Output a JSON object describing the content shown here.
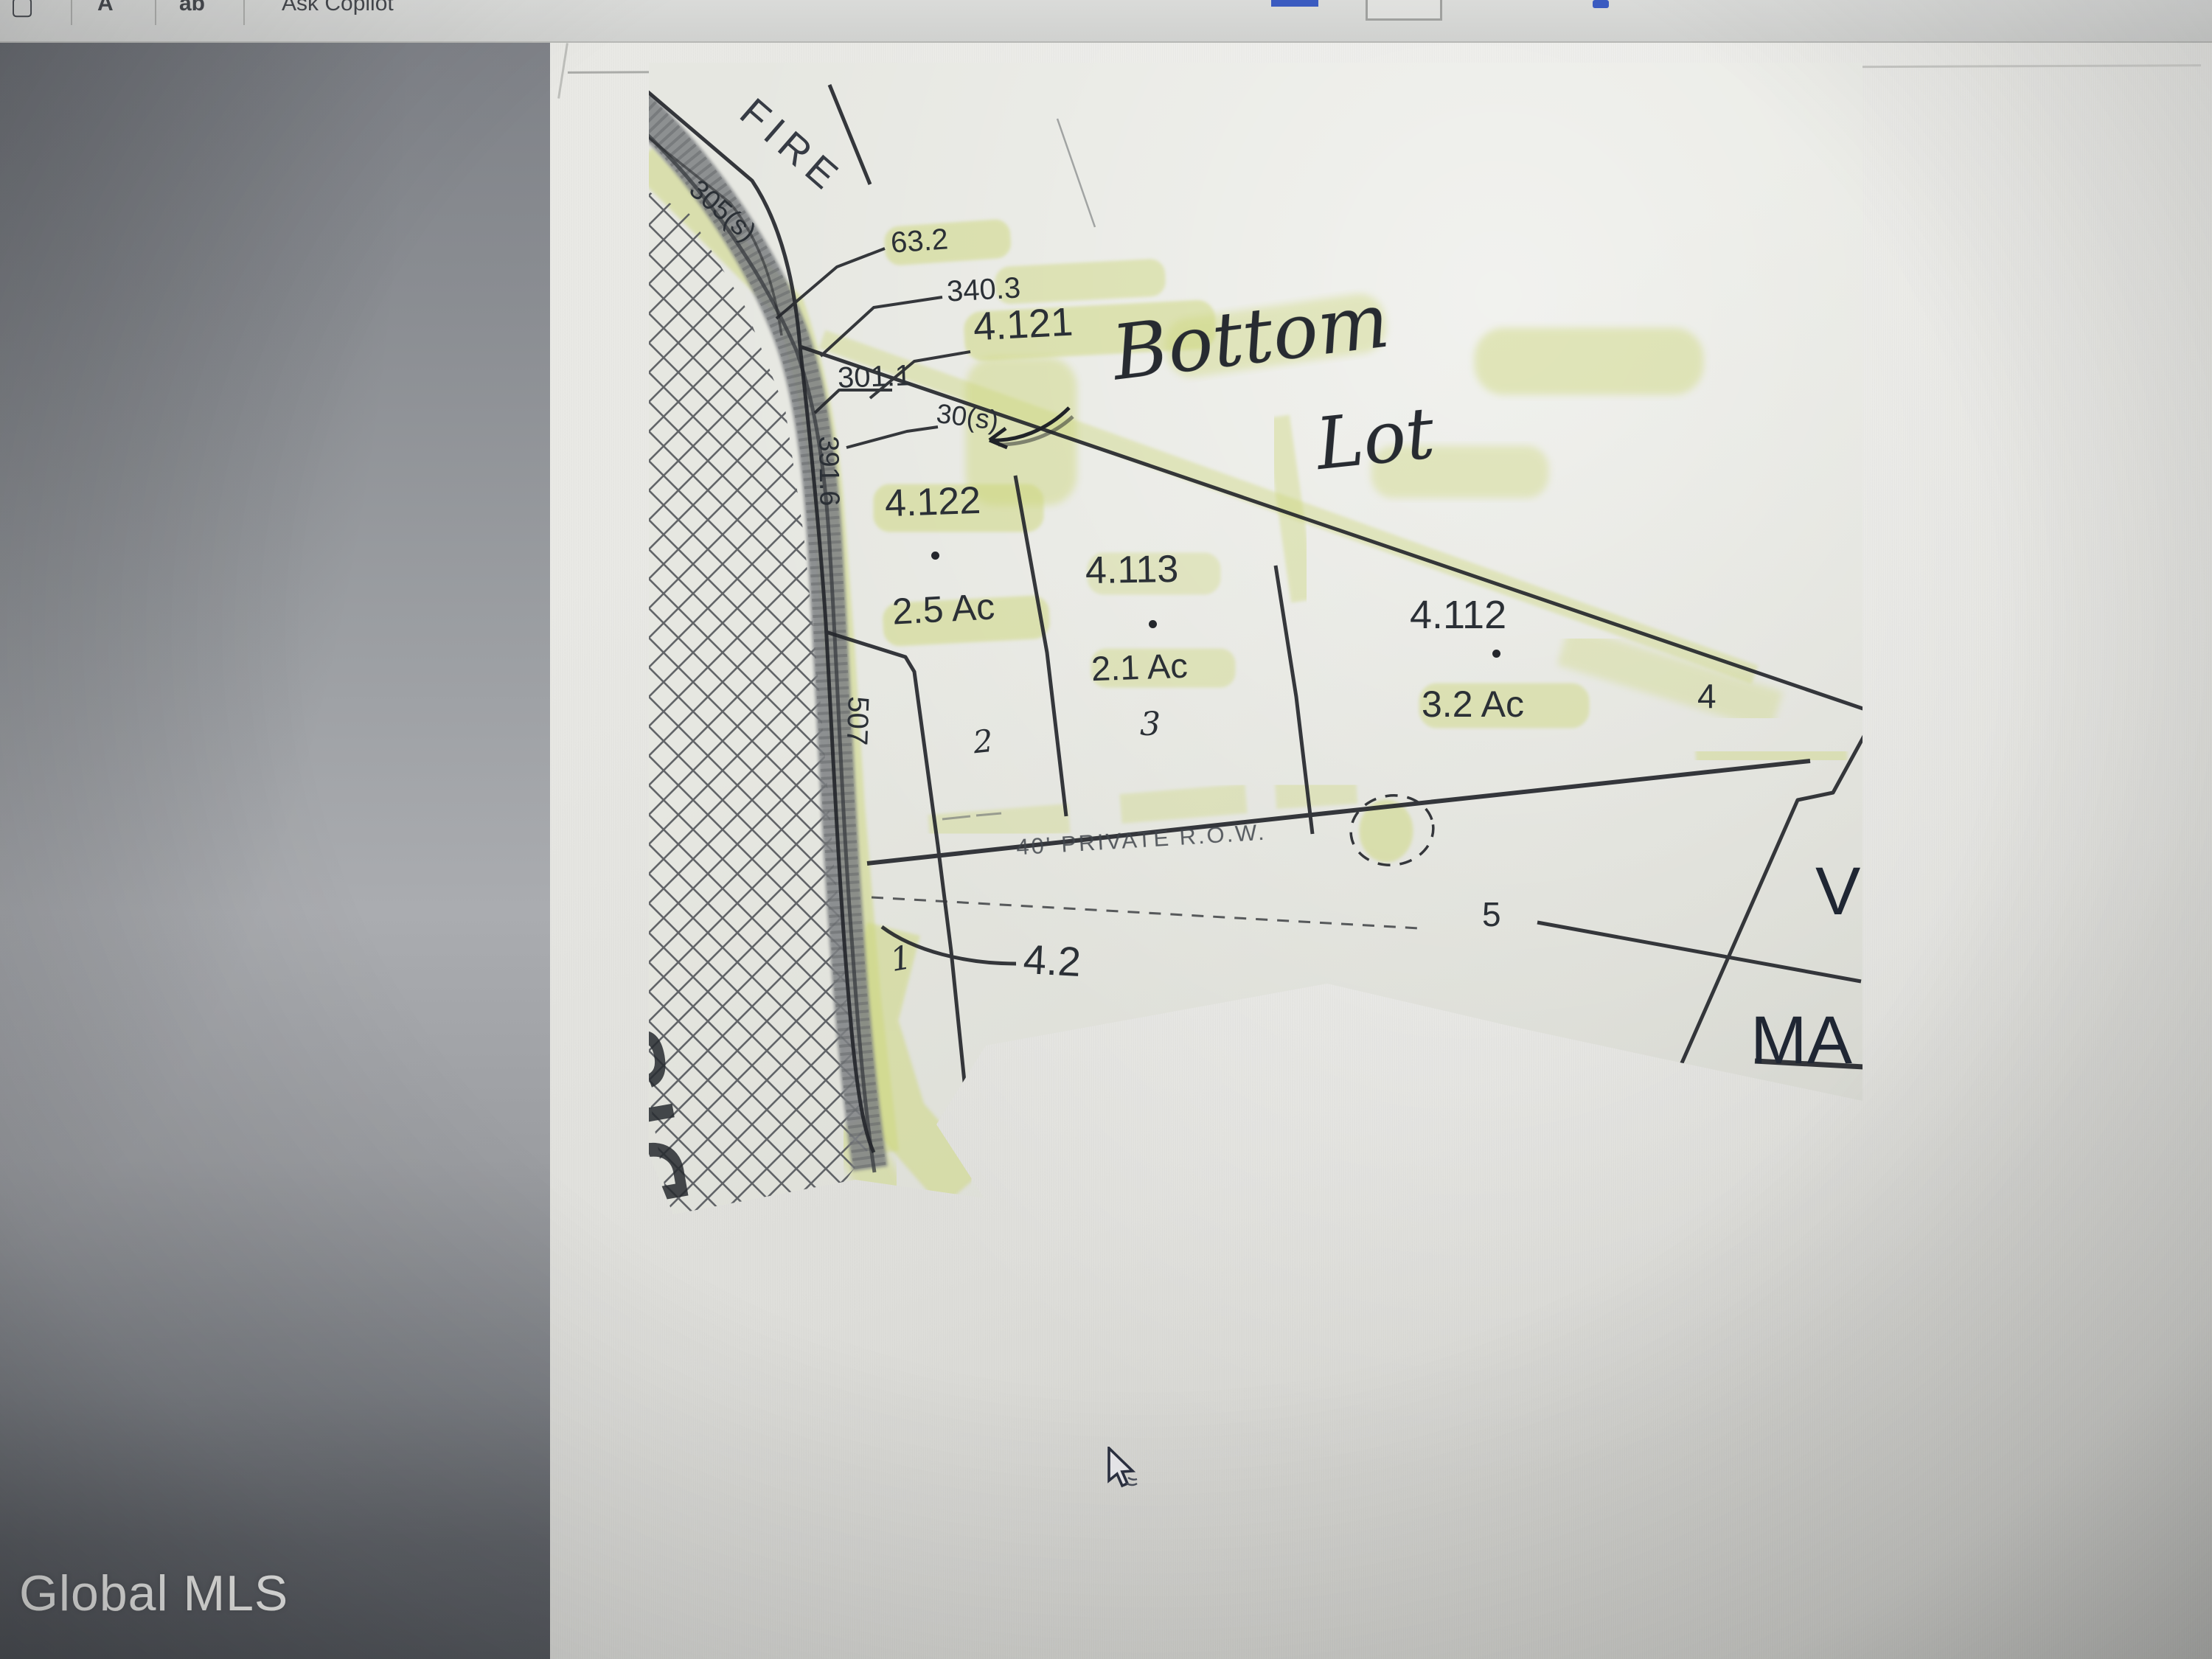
{
  "toolbar": {
    "icon1_glyph": "▢",
    "icon2_glyph": "A",
    "icon3_glyph": "ab",
    "ask_copilot_label": "Ask Copilot"
  },
  "watermark": {
    "label": "Global MLS"
  },
  "map": {
    "road_name": "FIRE",
    "row_label": "40' PRIVATE R.O.W.",
    "handwriting": {
      "line1": "Bottom",
      "line2": "Lot"
    },
    "dimensions": {
      "d305": "305(s)",
      "d632": "63.2",
      "d3403": "340.3",
      "d3011": "301.1",
      "d30s": "30(s)",
      "d3916": "391.6",
      "d507": "507"
    },
    "parcels": {
      "p4121": "4.121",
      "p4122": "4.122",
      "a4122": "2.5 Ac",
      "p4113": "4.113",
      "a4113": "2.1 Ac",
      "p4112": "4.112",
      "a4112": "3.2 Ac",
      "p42": "4.2"
    },
    "lots": {
      "l1": "1",
      "l2": "2",
      "l3": "3",
      "l4": "4",
      "l5": "5"
    },
    "partial_text": {
      "right_v": "V",
      "right_ma": "MA",
      "left_vertical": "DIS"
    },
    "colors": {
      "highlighter": "#cdd77a",
      "ink": "#2b3036",
      "road": "#7e8184"
    }
  }
}
